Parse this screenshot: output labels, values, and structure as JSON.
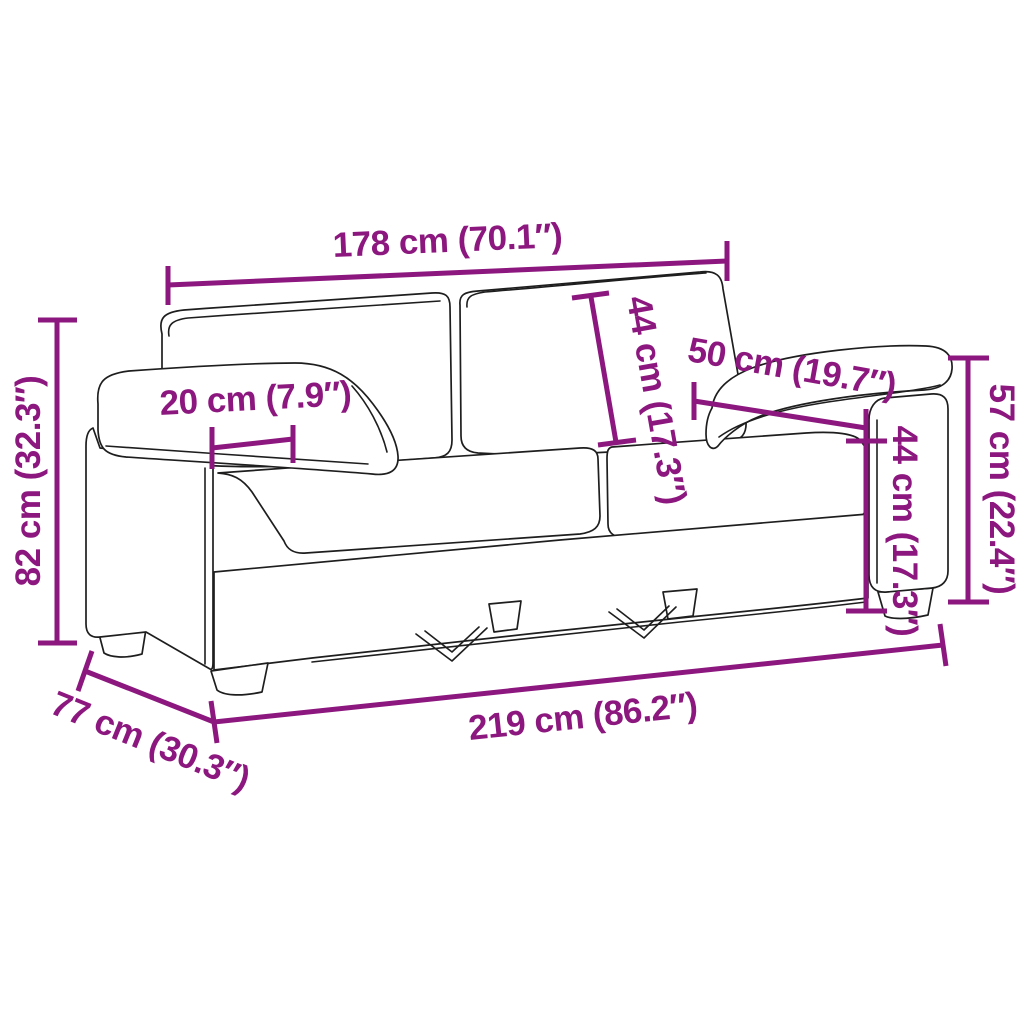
{
  "page": {
    "background": "#ffffff"
  },
  "diagram": {
    "type": "product-dimension-line-drawing",
    "subject": "2-seater sofa",
    "accent_color": "#8C177E",
    "outline_color": "#1E1E1E",
    "measurements": {
      "back_width": {
        "label": "178 cm (70.1″)",
        "cm": 178,
        "inches": 70.1
      },
      "total_height": {
        "label": "82 cm (32.3″)",
        "cm": 82,
        "inches": 32.3
      },
      "armrest_width": {
        "label": "20 cm (7.9″)",
        "cm": 20,
        "inches": 7.9
      },
      "back_cushion_height": {
        "label": "44 cm (17.3″)",
        "cm": 44,
        "inches": 17.3
      },
      "seat_depth": {
        "label": "50 cm (19.7″)",
        "cm": 50,
        "inches": 19.7
      },
      "seat_height": {
        "label": "44 cm (17.3″)",
        "cm": 44,
        "inches": 17.3
      },
      "armrest_height": {
        "label": "57 cm (22.4″)",
        "cm": 57,
        "inches": 22.4
      },
      "total_width": {
        "label": "219 cm (86.2″)",
        "cm": 219,
        "inches": 86.2
      },
      "total_depth": {
        "label": "77 cm (30.3″)",
        "cm": 77,
        "inches": 30.3
      }
    }
  }
}
